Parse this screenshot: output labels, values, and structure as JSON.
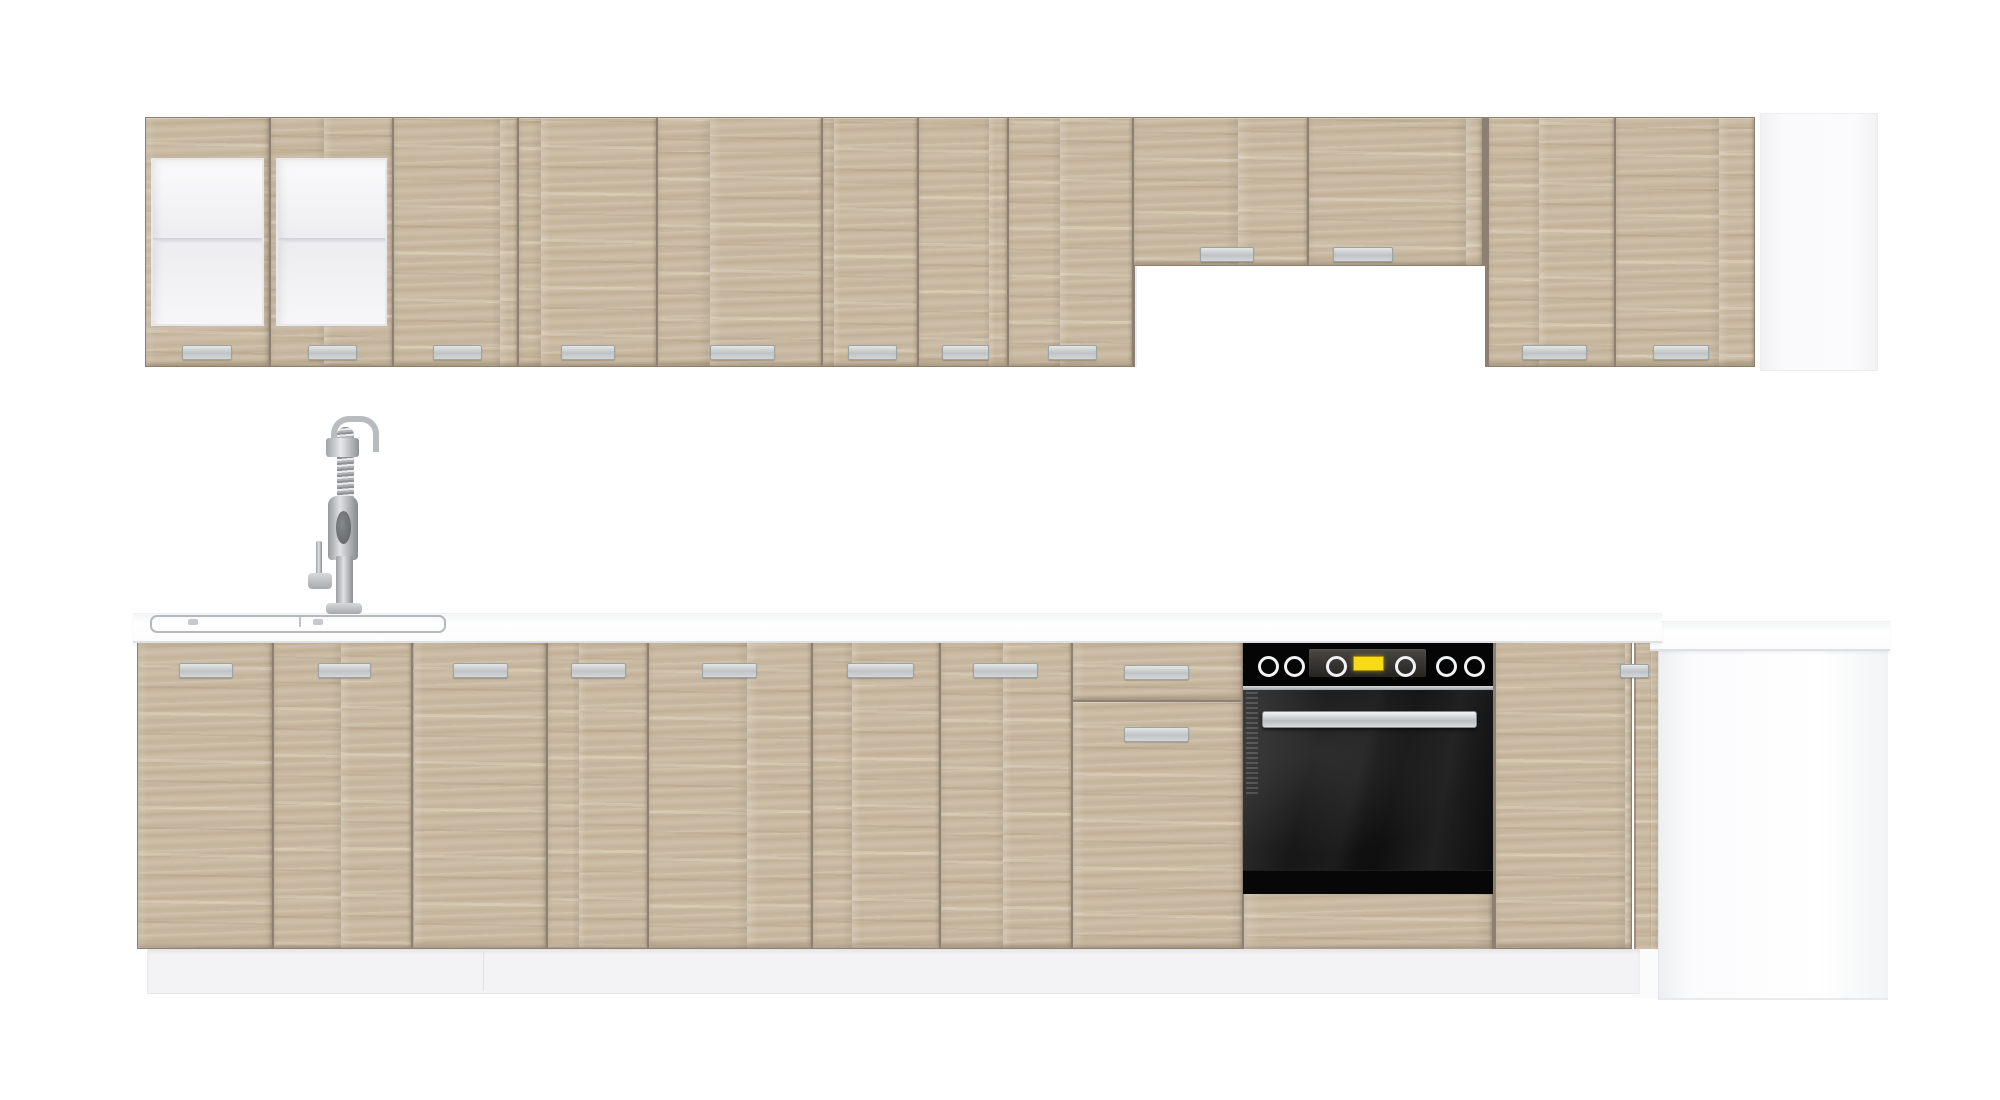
{
  "meta": {
    "description": "Product render of a modular kitchen furniture set: light sonoma-oak wall and base cabinets with aluminium bar handles, white worktop with inset sink and spring mixer tap, built-in black oven, cooker-hood recess and white corner/end panels on a white background",
    "width": 2000,
    "height": 1100
  },
  "colors": {
    "background": "#ffffff",
    "wood": "#c9b9a1",
    "door_gap": "#8d8070",
    "handle": "#c6cacc",
    "worktop": "#fdfdfe",
    "plinth": "#f3f3f5",
    "oven_black": "#050505",
    "oven_display_yellow": "#f8da17",
    "white_panel": "#fbfbfd"
  },
  "upper_row": {
    "y1": 117,
    "y2": 367,
    "handle_y": 345,
    "handle_h": 13,
    "glass": {
      "rail_h": 40,
      "stile_w": 5,
      "shelf_local_y": 80,
      "shelf_h": 5
    },
    "doors": [
      {
        "kind": "glass",
        "x1": 145,
        "x2": 270,
        "handle": [
          182,
          230
        ]
      },
      {
        "kind": "glass",
        "x1": 270,
        "x2": 393,
        "handle": [
          308,
          355
        ]
      },
      {
        "kind": "wood",
        "x1": 393,
        "x2": 518,
        "handle": [
          433,
          480
        ]
      },
      {
        "kind": "wood",
        "x1": 518,
        "x2": 657,
        "handle": [
          561,
          613
        ]
      },
      {
        "kind": "wood",
        "x1": 657,
        "x2": 822,
        "handle": [
          710,
          773
        ]
      },
      {
        "kind": "wood",
        "x1": 822,
        "x2": 918,
        "handle": [
          848,
          895
        ]
      },
      {
        "kind": "wood",
        "x1": 918,
        "x2": 1008,
        "handle": [
          942,
          987
        ]
      },
      {
        "kind": "wood",
        "x1": 1008,
        "x2": 1133,
        "handle": [
          1048,
          1095
        ]
      },
      {
        "kind": "flap",
        "x1": 1133,
        "x2": 1308,
        "y2": 266,
        "handle": [
          1200,
          1252
        ],
        "handle_y": 247
      },
      {
        "kind": "flap",
        "x1": 1308,
        "x2": 1483,
        "y2": 266,
        "handle": [
          1333,
          1391
        ],
        "handle_y": 247
      },
      {
        "kind": "wood",
        "x1": 1488,
        "x2": 1615,
        "handle": [
          1522,
          1585
        ]
      },
      {
        "kind": "wood",
        "x1": 1615,
        "x2": 1755,
        "handle": [
          1653,
          1707
        ]
      }
    ],
    "hood_recess": {
      "x1": 1135,
      "x2": 1483,
      "y1": 266,
      "y2": 367
    },
    "end_panel": {
      "x1": 1760,
      "x2": 1876,
      "y1": 113,
      "y2": 369
    }
  },
  "base_row": {
    "y1": 640,
    "y2": 949,
    "handle_y": 663,
    "handle_h": 13,
    "doors": [
      {
        "x1": 137,
        "x2": 273,
        "handle": [
          179,
          231
        ]
      },
      {
        "x1": 273,
        "x2": 412,
        "handle": [
          318,
          369
        ]
      },
      {
        "x1": 412,
        "x2": 547,
        "handle": [
          453,
          506
        ]
      },
      {
        "x1": 547,
        "x2": 648,
        "handle": [
          571,
          624
        ]
      },
      {
        "x1": 648,
        "x2": 812,
        "handle": [
          702,
          755
        ]
      },
      {
        "x1": 812,
        "x2": 940,
        "handle": [
          847,
          912
        ]
      },
      {
        "x1": 940,
        "x2": 1072,
        "handle": [
          973,
          1036
        ]
      },
      {
        "x1": 1495,
        "x2": 1632,
        "handle": null
      }
    ],
    "under_oven_panel": {
      "x1": 1244,
      "x2": 1492,
      "y1": 893,
      "y2": 949
    },
    "drawer_unit": {
      "x1": 1072,
      "x2": 1243,
      "split_y": 701,
      "handles": [
        {
          "x1": 1124,
          "x2": 1187,
          "y": 665
        },
        {
          "x1": 1124,
          "x2": 1187,
          "y": 727
        }
      ]
    },
    "corner_door": {
      "x1": 1634,
      "x2": 1659,
      "y1": 643,
      "y2": 960,
      "handle": {
        "x1": 1620,
        "x2": 1647,
        "y": 664
      }
    },
    "corner_cabinet": {
      "x1": 1658,
      "x2": 1887,
      "y1": 640,
      "y2": 998
    },
    "plinth": {
      "x1": 147,
      "x2": 1640,
      "y1": 949,
      "y2": 993,
      "seams": [
        483
      ]
    },
    "corner_fill": {
      "x1": 1632,
      "x2": 1660,
      "y1": 949,
      "y2": 998
    }
  },
  "worktop": {
    "main": {
      "x1": 133,
      "x2": 1662,
      "y1": 613,
      "y2": 640
    },
    "corner": {
      "x1": 1650,
      "x2": 1890,
      "y1": 621,
      "y2": 648
    }
  },
  "sink": {
    "x1": 150,
    "x2": 442,
    "y1": 615,
    "y2": 629,
    "divider_x": 299,
    "drains": [
      [
        188,
        619
      ],
      [
        313,
        619
      ]
    ]
  },
  "faucet": {
    "parts": [
      [
        "tap-arc",
        "fc-arc",
        331,
        416,
        36,
        30
      ],
      [
        "tap-upper-pipe",
        "fc-metal2",
        339,
        445,
        12,
        60
      ],
      [
        "tap-coil",
        "fc-coil",
        337,
        427,
        17,
        76
      ],
      [
        "tap-head",
        "fc-metal",
        326,
        438,
        33,
        19
      ],
      [
        "tap-body",
        "fc-body",
        328,
        496,
        30,
        64
      ],
      [
        "tap-spout-hole",
        "fc-hole",
        336,
        511,
        15,
        33
      ],
      [
        "tap-column",
        "fc-metal2",
        336,
        556,
        17,
        52
      ],
      [
        "tap-lever-rod",
        "fc-metal2",
        316,
        541,
        6,
        38
      ],
      [
        "tap-lever-knob",
        "fc-base",
        308,
        573,
        24,
        16
      ],
      [
        "tap-base-plate",
        "fc-base",
        326,
        603,
        36,
        11
      ]
    ]
  },
  "oven": {
    "x1": 1243,
    "x2": 1493,
    "panel_y1": 641,
    "panel_y2": 686,
    "divider_y1": 686,
    "divider_y2": 690,
    "door_y1": 690,
    "door_y2": 870,
    "bottom_y2": 893,
    "knob_cy": 663,
    "knob_d": 15,
    "knobs": [
      1265,
      1291,
      1333,
      1402,
      1443,
      1471
    ],
    "display": {
      "x1": 1309,
      "x2": 1426,
      "y1": 649,
      "y2": 677
    },
    "yellow": {
      "x1": 1353,
      "x2": 1382,
      "y1": 656,
      "y2": 669
    },
    "handle": {
      "x1": 1262,
      "x2": 1475,
      "y1": 711,
      "y2": 726
    },
    "vent": {
      "x1": 1246,
      "x2": 1258,
      "y1": 692,
      "y2": 795
    }
  }
}
